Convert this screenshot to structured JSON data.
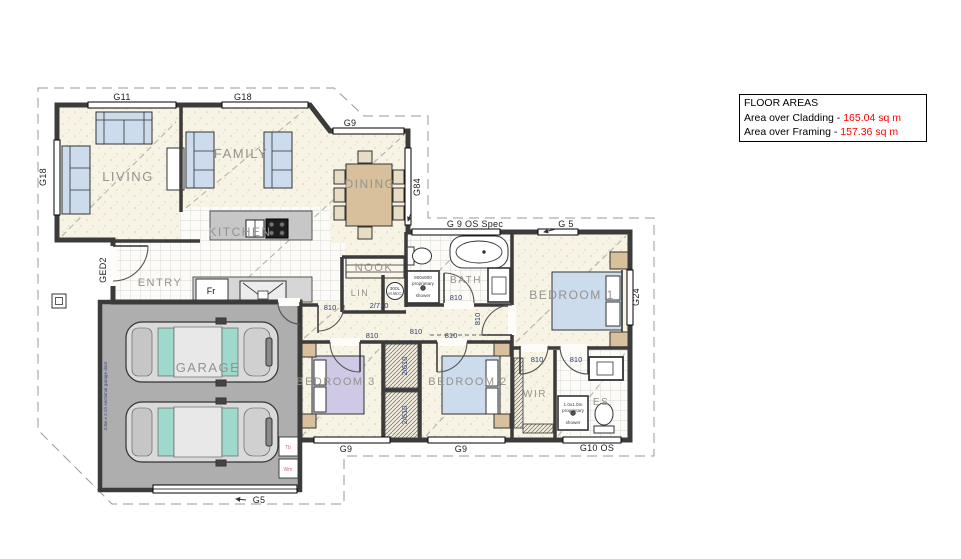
{
  "floor_areas": {
    "heading": "FLOOR AREAS",
    "rows": [
      {
        "label": "Area over Cladding - ",
        "value": "165.04 sq m"
      },
      {
        "label": "Area over Framing - ",
        "value": "157.36 sq m"
      }
    ]
  },
  "rooms": {
    "living": "LIVING",
    "family": "FAMILY",
    "dining": "DINING",
    "kitchen": "KITCHEN",
    "entry": "ENTRY",
    "nook": "NOOK",
    "lin": "LIN",
    "bath": "BATH",
    "bedroom1": "BEDROOM 1",
    "bedroom2": "BEDROOM 2",
    "bedroom3": "BEDROOM 3",
    "wir": "WIR",
    "es": "ES",
    "garage": "GARAGE"
  },
  "window_labels": {
    "g11": "G11",
    "g18_top": "G18",
    "g18_left": "G18",
    "g9_family": "G9",
    "g84_dining": "G84",
    "g9_os_spec": "G 9 OS Spec",
    "g5_bed1": "G 5",
    "g24_bed1": "G24",
    "g9_bed3": "G9",
    "g9_bed2": "G9",
    "g10_os_es": "G10 OS",
    "g5_garage": "G5",
    "ged2_entry": "GED2"
  },
  "dimensions": {
    "door_810": "810",
    "linen_doors": "2/710",
    "wardrobe_doors": "2/610"
  },
  "fixtures": {
    "fridge": "Fr",
    "hwc": [
      "300L",
      "H.W.C"
    ],
    "bath_shower": [
      "900x900",
      "proprietary",
      "shower"
    ],
    "es_shower": [
      "1.0x1.0m",
      "proprietary",
      "shower"
    ],
    "laundry_tub": "Tb",
    "washing_machine": "Wm",
    "garage_door": "4.8w x 2.1h sectional garage door"
  },
  "colors": {
    "wall": "#3b3b3b",
    "floor_cream": "#f7f3e5",
    "tile_line": "#c9c9c9",
    "garage_floor": "#aeaeae",
    "furniture_blue": "#ccdcec",
    "furniture_tan": "#d8c09c",
    "bed3_purple": "#cfc9e6",
    "car_glass": "#9fd8cc",
    "label_gray": "#95928e",
    "dim_blue": "#2b3f6e",
    "value_red": "#ff0000"
  }
}
